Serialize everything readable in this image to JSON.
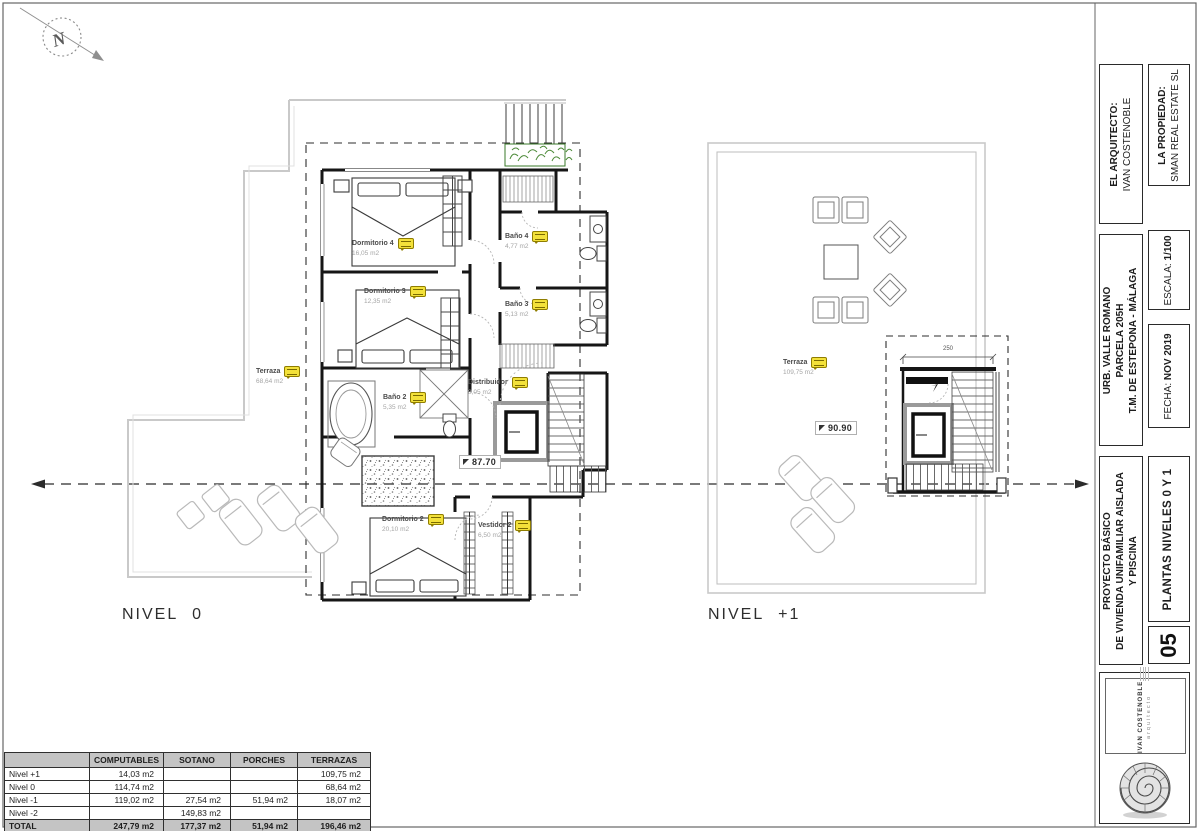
{
  "sheet": {
    "compass_letter": "N",
    "titleblock": {
      "architect_label": "EL ARQUITECTO:",
      "architect_name": "IVAN COSTENOBLE",
      "property_label": "LA PROPIEDAD:",
      "property_name": "SMAN REAL ESTATE SL",
      "location_line1": "URB. VALLE ROMANO",
      "location_line2": "PARCELA 205H",
      "location_line3": "T.M. DE ESTEPONA - MÁLAGA",
      "escala_label": "ESCALA:",
      "escala_value": "1/100",
      "fecha_label": "FECHA:",
      "fecha_value": "NOV 2019",
      "project_line1": "PROYECTO BÁSICO",
      "project_line2": "DE VIVIENDA UNIFAMILIAR AISLADA",
      "project_line3": "Y PISCINA",
      "sheet_title": "PLANTAS NIVELES 0 Y 1",
      "sheet_number": "05",
      "logo_name": "IVAN COSTENOBLE",
      "logo_subtitle": "arquitecto"
    }
  },
  "plans": {
    "nivel0": {
      "title": "NIVEL 0",
      "level_marker": "87.70",
      "rooms": [
        {
          "name": "Dormitorio 4",
          "area": "16,05 m2"
        },
        {
          "name": "Dormitorio 3",
          "area": "12,35 m2"
        },
        {
          "name": "Baño 4",
          "area": "4,77 m2"
        },
        {
          "name": "Baño 3",
          "area": "5,13 m2"
        },
        {
          "name": "Terraza",
          "area": "68,64 m2"
        },
        {
          "name": "Baño 2",
          "area": "5,35 m2"
        },
        {
          "name": "Distribuidor",
          "area": "8,05 m2"
        },
        {
          "name": "Dormitorio 2",
          "area": "20,10 m2"
        },
        {
          "name": "Vestidor 2",
          "area": "6,50 m2"
        }
      ]
    },
    "nivel1": {
      "title": "NIVEL +1",
      "level_marker": "90.90",
      "stair_dim": "250",
      "rooms": [
        {
          "name": "Terraza",
          "area": "109,75 m2"
        }
      ]
    }
  },
  "table": {
    "headers": [
      "",
      "COMPUTABLES",
      "SOTANO",
      "PORCHES",
      "TERRAZAS"
    ],
    "rows": [
      {
        "label": "Nivel +1",
        "cells": [
          "14,03 m2",
          "",
          "",
          "109,75 m2"
        ]
      },
      {
        "label": "Nivel 0",
        "cells": [
          "114,74 m2",
          "",
          "",
          "68,64 m2"
        ]
      },
      {
        "label": "Nivel -1",
        "cells": [
          "119,02 m2",
          "27,54 m2",
          "51,94 m2",
          "18,07 m2"
        ]
      },
      {
        "label": "Nivel -2",
        "cells": [
          "",
          "149,83 m2",
          "",
          ""
        ]
      },
      {
        "label": "TOTAL",
        "cells": [
          "247,79 m2",
          "177,37 m2",
          "51,94 m2",
          "196,46 m2"
        ]
      }
    ]
  },
  "colors": {
    "tag_yellow": "#f3e13a",
    "plant_green": "#4c8a38",
    "terrace_gray": "#c9c9c9",
    "wall_black": "#161616"
  }
}
